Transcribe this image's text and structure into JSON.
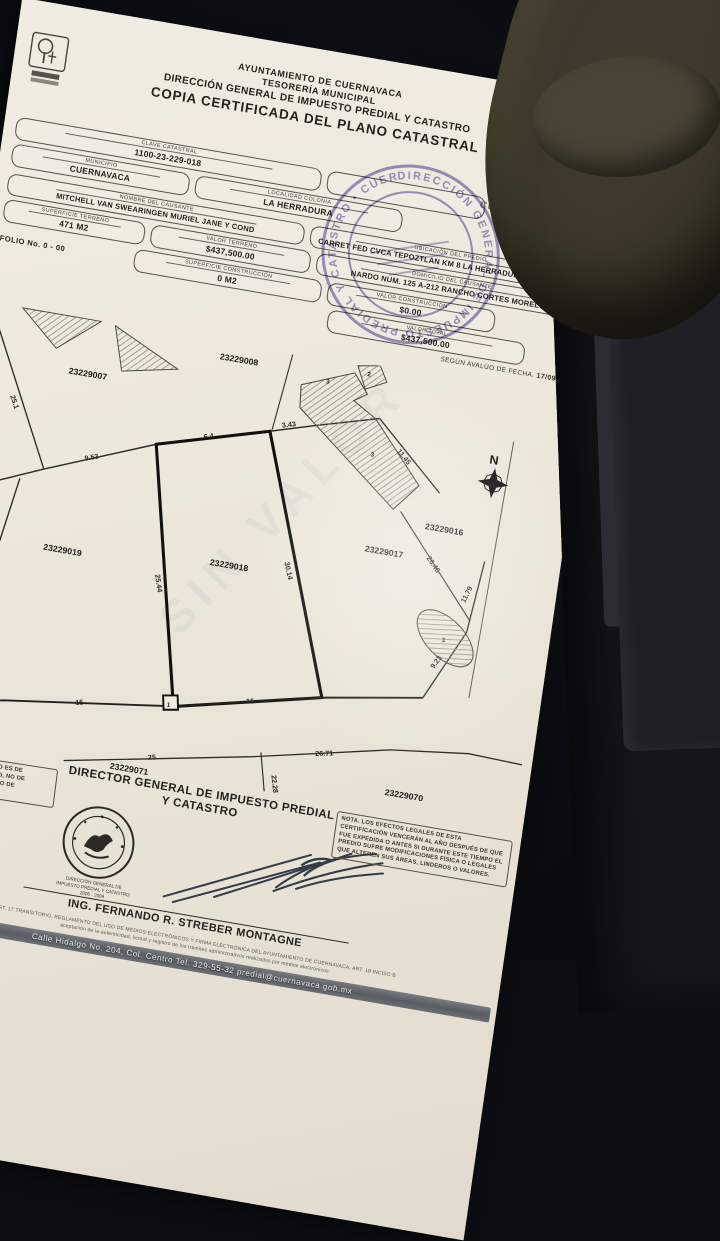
{
  "header": {
    "municipality": "AYUNTAMIENTO DE CUERNAVACA",
    "office": "TESORERÍA MUNICIPAL",
    "department": "DIRECCIÓN GENERAL DE IMPUESTO PREDIAL Y CATASTRO",
    "title": "COPIA CERTIFICADA DEL PLANO CATASTRAL"
  },
  "brand": {
    "wordmark": "cuernavaca"
  },
  "form": {
    "clave": {
      "label": "CLAVE CATASTRAL",
      "value": "1100-23-229-018"
    },
    "municipio": {
      "label": "MUNICIPIO",
      "value": "CUERNAVACA"
    },
    "localidad": {
      "label": "LOCALIDAD COLONIA",
      "value": "LA HERRADURA"
    },
    "fecha_expedicion": {
      "label": "FECHA DE EXPEDICIÓN",
      "day": "29",
      "year": "2009",
      "year_caption": "AÑO"
    },
    "nombre": {
      "label": "NOMBRE DEL CAUSANTE",
      "value": "MITCHELL VAN SWEARINGEN MURIEL JANE Y COND"
    },
    "ubicacion": {
      "label": "UBICACIÓN DEL PREDIO",
      "value": "CARRET FED CVCA TEPOZTLAN KM 8 LA HERRADURA CUERNAVACA"
    },
    "superficie_terreno": {
      "label": "SUPERFICIE TERRENO",
      "value": "471 M2"
    },
    "valor_terreno": {
      "label": "VALOR TERRENO",
      "value": "$437,500.00"
    },
    "domicilio": {
      "label": "DOMICILIO DEL CAUSANTE",
      "value": "NARDO NUM. 125 A-212 RANCHO CORTES MORELOS"
    },
    "folio": {
      "label": "FOLIO No.",
      "value": "0 - 00"
    },
    "superficie_construccion": {
      "label": "SUPERFICIE CONSTRUCCIÓN",
      "value": "0 M2"
    },
    "valor_construccion": {
      "label": "VALOR CONSTRUCCIÓN",
      "value": "$0.00"
    },
    "valor_total": {
      "label": "VALOR TOTAL",
      "value": "$437,500.00"
    },
    "avaluo": {
      "label": "SEGÚN AVALÚO DE FECHA.",
      "value": "17/09/2007"
    }
  },
  "map": {
    "compass": "N",
    "watermark": "SIN VALOR",
    "parcels": [
      "23229007",
      "23229008",
      "23229019",
      "23229018",
      "23229017",
      "23229016",
      "23229071",
      "23229070"
    ],
    "zones": [
      "2",
      "3",
      "3",
      "1",
      "1"
    ],
    "measurements": {
      "m25_1": "25.1",
      "m5_46": "5.46",
      "m9_53": "9.53",
      "m6_4": "6.4",
      "m3_43": "3.43",
      "m11_45": "11.45",
      "m24_32": "24.32",
      "m25_44": "25.44",
      "m30_14": "30.14",
      "m26_46": "26.46",
      "m11_79": "11.79",
      "m9_23": "9.23",
      "m15a": "15",
      "m15b": "15",
      "m16": "16",
      "m25": "25",
      "m22_28": "22.28",
      "m26_71": "26.71"
    }
  },
  "stamp": {
    "arc_text": "DIRECCIÓN GENERAL DE IMPUESTO PREDIAL Y CATASTRO • CUERNAVACA •"
  },
  "footer": {
    "left_note": "NOTA. ESTE DOCUMENTO ES DE CARÁCTER INFORMATIVO, NO DE CARÁCTER CONSTITUTIVO DE DERECHOS.",
    "title_line1": "DIRECTOR GENERAL DE IMPUESTO PREDIAL",
    "title_line2": "Y CATASTRO",
    "seal_ring_text": "AYUNTAMIENTO DE CUERNAVACA",
    "seal_caption_line1": "DIRECCIÓN GENERAL DE",
    "seal_caption_line2": "IMPUESTO PREDIAL Y CATASTRO",
    "seal_caption_line3": "2006 - 2009",
    "signer": "ING. FERNANDO R. STREBER MONTAGNE",
    "right_note": "NOTA. LOS EFECTOS LEGALES DE ESTA CERTIFICACIÓN VENCERÁN AL AÑO DESPUÉS DE QUE FUE EXPEDIDA O ANTES SI DURANTE ESTE TIEMPO EL PREDIO SUFRE MODIFICACIONES FÍSICA O LEGALES QUE ALTEREN SUS ÁREAS, LINDEROS O VALORES.",
    "fine_print_line1": "ART. 17 TRANSITORIO, REGLAMENTO DEL USO DE MEDIOS ELECTRÓNICOS Y FIRMA ELECTRÓNICA DEL AYUNTAMIENTO DE CUERNAVACA, ART. 18 INCISO B",
    "fine_print_line2": "aceptación de la autenticidad, licitud y registro de los trámites administrativos realizados por medios electrónicos",
    "address_bar": "Calle Hidalgo No. 204, Col. Centro  Tel. 329-55-32  predial@cuernavaca.gob.mx"
  }
}
